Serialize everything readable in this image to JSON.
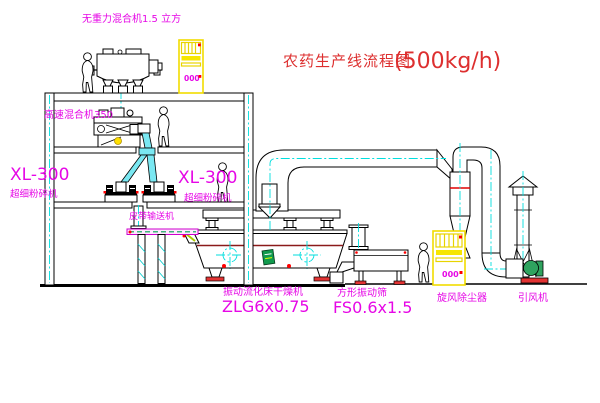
{
  "title": {
    "text": "农药生产线流程图",
    "capacity": "(500kg/h)"
  },
  "labels": {
    "gravity_mixer": "无重力混合机1.5 立方",
    "high_speed_mixer": "高速混合机350",
    "left_mill_model": "XL-300",
    "left_mill_name": "超细粉碎机",
    "mid_mill_model": "XL-300",
    "mid_mill_name": "超细粉碎机",
    "belt_conveyor": "皮带输送机",
    "fluid_bed_dryer": "振动流化床干燥机",
    "fluid_bed_dryer_model": "ZLG6x0.75",
    "square_sieve": "方形振动筛",
    "square_sieve_model": "FS0.6x1.5",
    "cyclone": "旋风除尘器",
    "induced_draft_fan": "引风机",
    "cabinet_readout": "000"
  },
  "colors": {
    "label": "#e607e6",
    "title": "#dd2f2f",
    "centerline": "#00dede",
    "cabinet": "#f2dc00",
    "accent_red": "#ff0000",
    "pipe_fill": "#7ae8f2",
    "fan_green": "#2fa35f",
    "line": "#000000"
  }
}
